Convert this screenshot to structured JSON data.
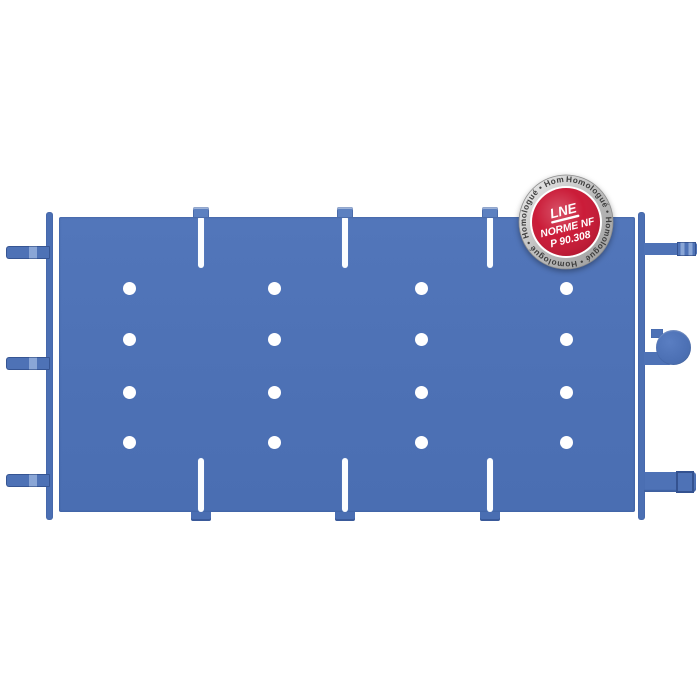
{
  "product": {
    "badge": {
      "ring_text": "Homologué • Homologué • Homologué • Homologué • Homologué •",
      "org": "LNE",
      "standard": "NORME NF",
      "code": "P 90.308",
      "colors": {
        "red": "#c8102e",
        "ring_silver": "#c4c4c4",
        "center_text": "#ffffff",
        "ring_text": "#3d3d3d"
      }
    },
    "panel": {
      "color": "#4e72b6",
      "background": "#ffffff",
      "rivet_color": "#ffffff",
      "rivet_columns_x": [
        129,
        274,
        421,
        566
      ],
      "rivet_rows_y": [
        288,
        339,
        392,
        442
      ],
      "joint_columns_x": [
        201,
        345,
        490
      ],
      "left_tab_rows_y": [
        246,
        357,
        474
      ]
    }
  }
}
